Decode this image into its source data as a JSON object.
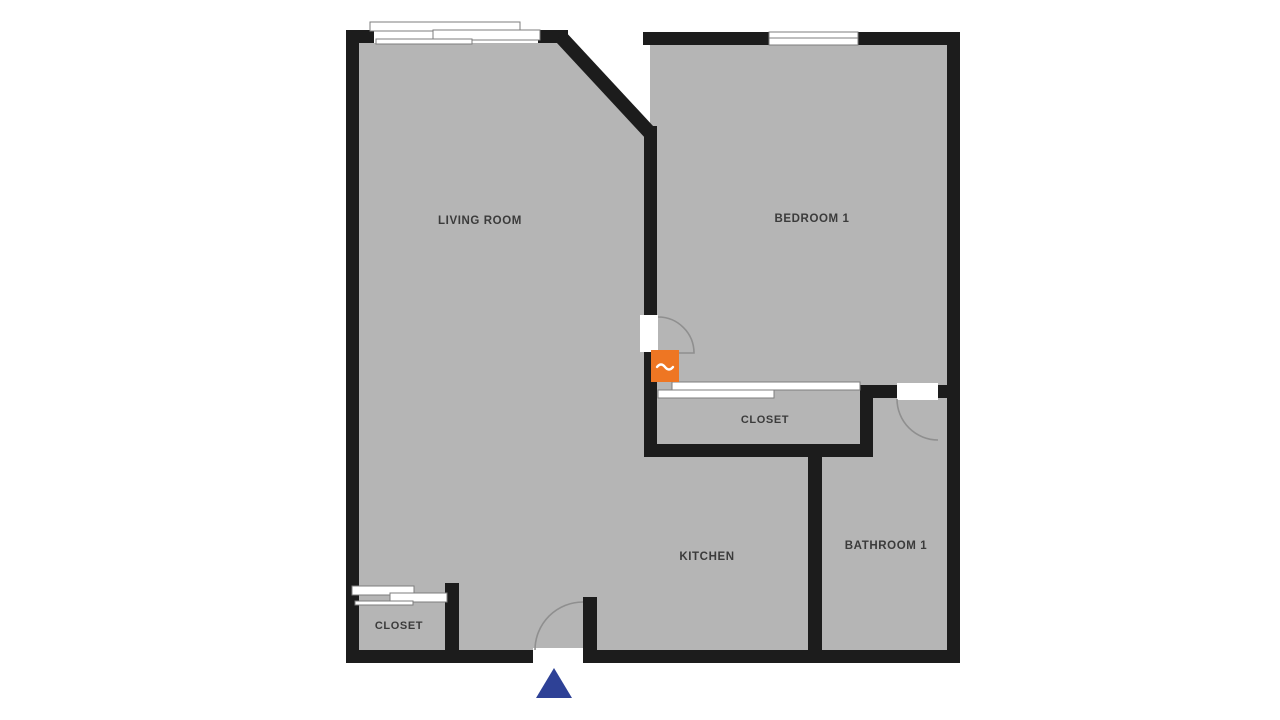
{
  "floorplan": {
    "rooms": {
      "living_room": {
        "label": "LIVING ROOM"
      },
      "bedroom_1": {
        "label": "BEDROOM 1"
      },
      "bedroom_closet": {
        "label": "CLOSET"
      },
      "kitchen": {
        "label": "KITCHEN"
      },
      "bathroom_1": {
        "label": "BATHROOM 1"
      },
      "entry_closet": {
        "label": "CLOSET"
      }
    },
    "colors": {
      "background": "#ffffff",
      "floor": "#b5b5b5",
      "wall": "#1c1c1c",
      "opening": "#ffffff",
      "brand_marker": "#ee7623",
      "entrance_marker": "#2e4196"
    },
    "markers": {
      "brand": "orange-logo-badge",
      "entrance": "blue-entrance-triangle"
    }
  }
}
